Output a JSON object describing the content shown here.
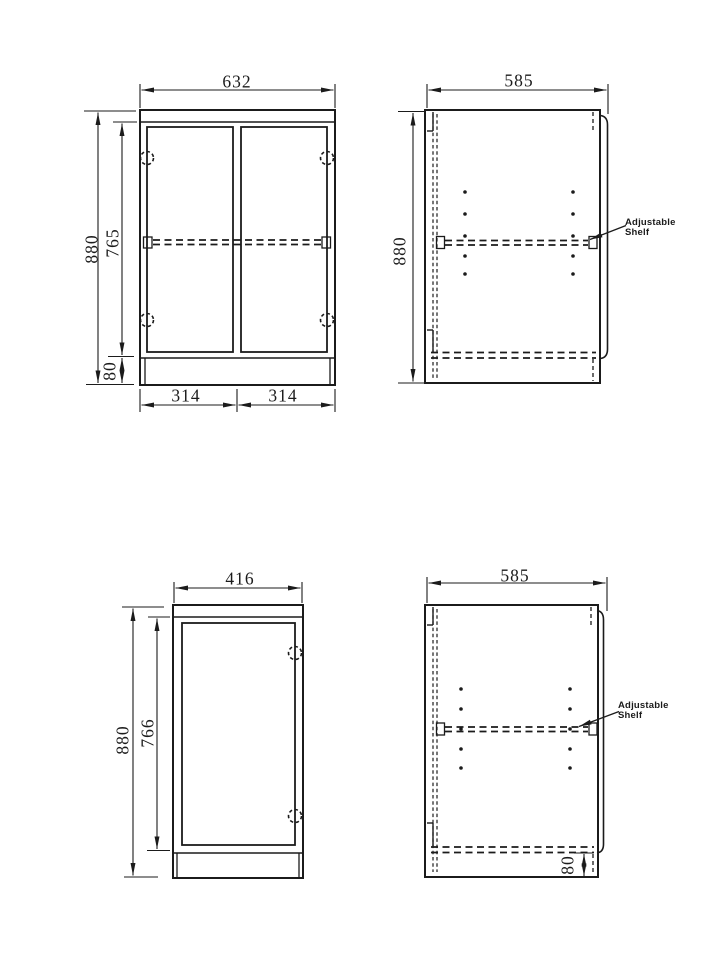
{
  "colors": {
    "line": "#1b1b1b",
    "background": "#ffffff"
  },
  "symbols": {
    "hinge": "dashed-circle-icon",
    "shelf_pin": "dot",
    "hidden_edge": "dashed-line"
  },
  "views": {
    "front_two_door": {
      "width": "632",
      "height": "880",
      "door_height": "765",
      "plinth_height": "80",
      "door_widths": [
        "314",
        "314"
      ]
    },
    "side_upper": {
      "depth": "585",
      "height": "880",
      "note": "Adjustable Shelf"
    },
    "front_one_door": {
      "width": "416",
      "height": "880",
      "door_height": "766"
    },
    "side_lower": {
      "depth": "585",
      "plinth_height": "80",
      "note": "Adjustable Shelf"
    }
  }
}
